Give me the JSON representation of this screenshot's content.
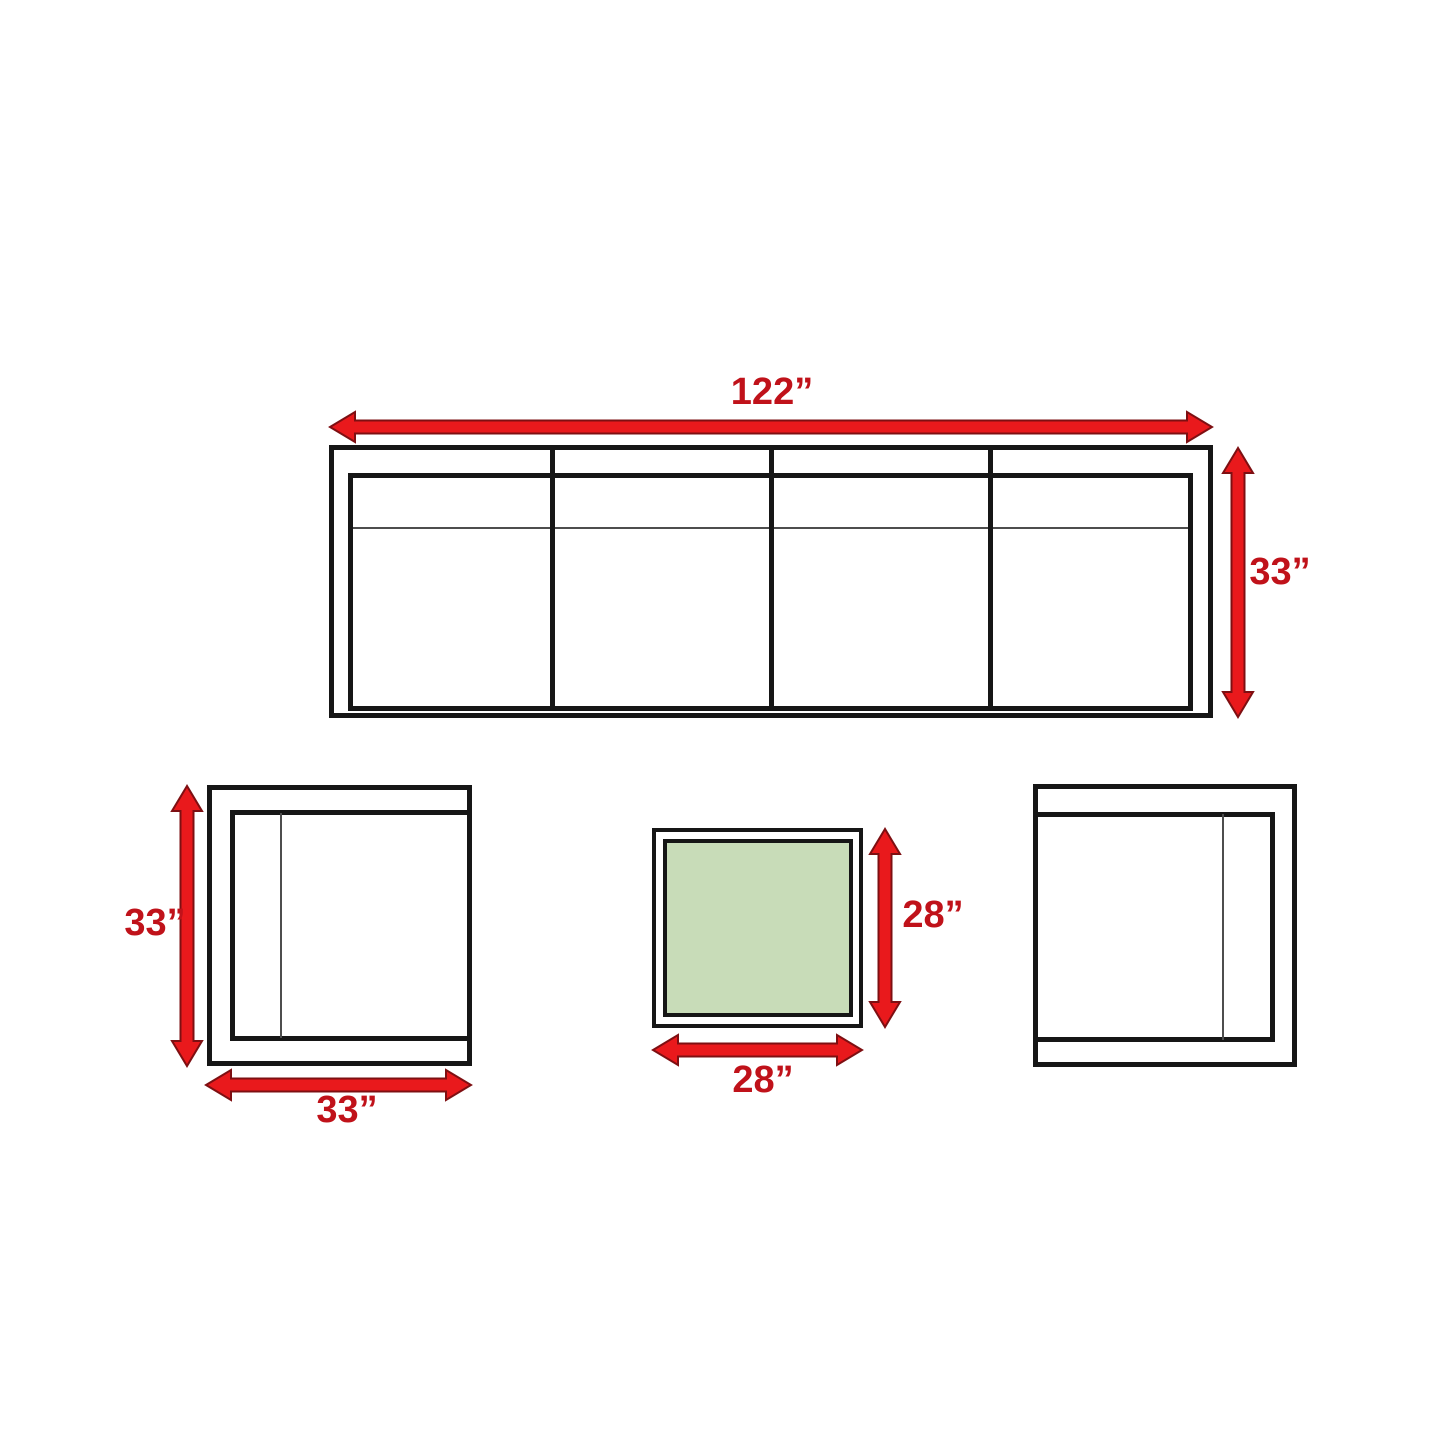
{
  "colors": {
    "background": "#FFFFFF",
    "outline_black": "#161616",
    "thin_line_gray": "#4D4D4D",
    "arrow_fill": "#E9191C",
    "arrow_outline": "#7E0F12",
    "label_red": "#C0121A",
    "table_top_green": "#C8DCB8"
  },
  "sofa": {
    "width_label": "122”",
    "depth_label": "33”",
    "seat_sections": 4
  },
  "armchair_left": {
    "depth_label": "33”",
    "width_label": "33”"
  },
  "coffee_table": {
    "depth_label": "28”",
    "width_label": "28”"
  }
}
